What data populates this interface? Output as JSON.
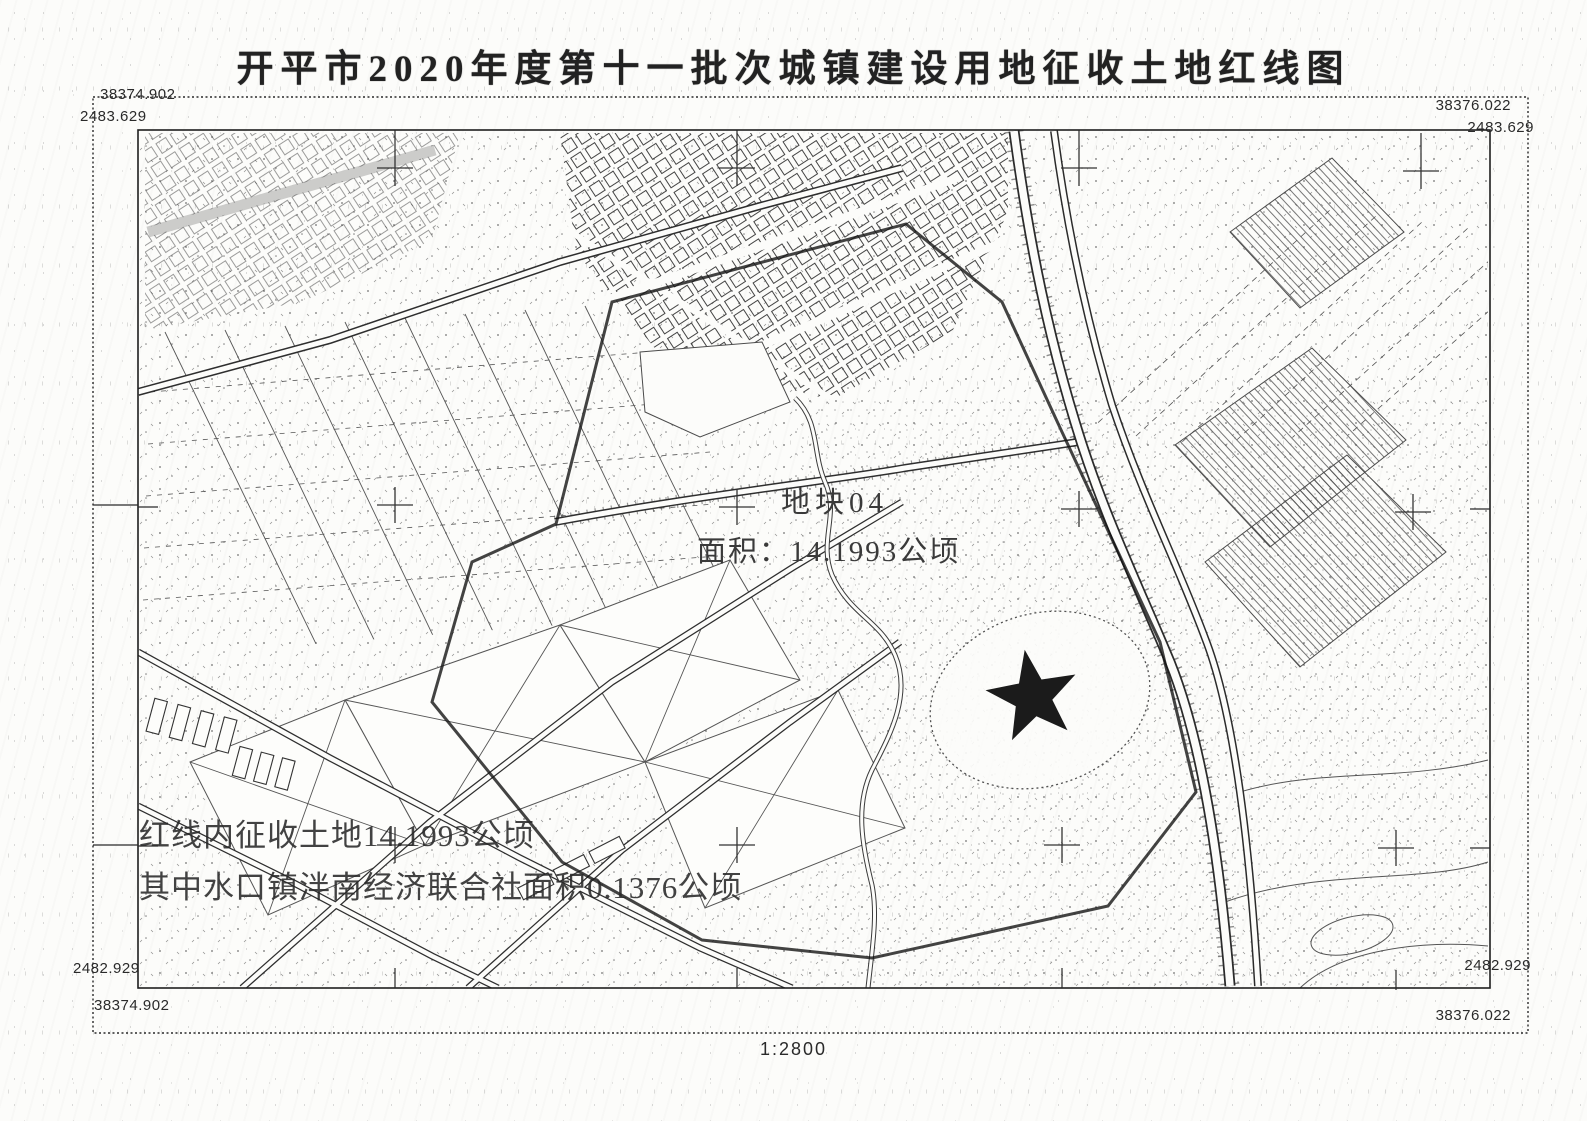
{
  "title": "开平市2020年度第十一批次城镇建设用地征收土地红线图",
  "frame": {
    "top_left": {
      "x": "38374.902",
      "y": "2483.629"
    },
    "top_right": {
      "x": "38376.022",
      "y": "2483.629"
    },
    "bottom_left": {
      "x": "38374.902",
      "y": "2482.929"
    },
    "bottom_right": {
      "x": "38376.022",
      "y": "2482.929"
    }
  },
  "parcel": {
    "id_label": "地块04",
    "area_label": "面积：14.1993公顷"
  },
  "notes": [
    "红线内征收土地14.1993公顷",
    "其中水口镇泮南经济联合社面积0.1376公顷"
  ],
  "scale_label": "1:2800",
  "symbols": {
    "star": "five-pointed-star"
  },
  "colors": {
    "ink": "#1c1c1c",
    "paper": "#fcfcfa"
  }
}
